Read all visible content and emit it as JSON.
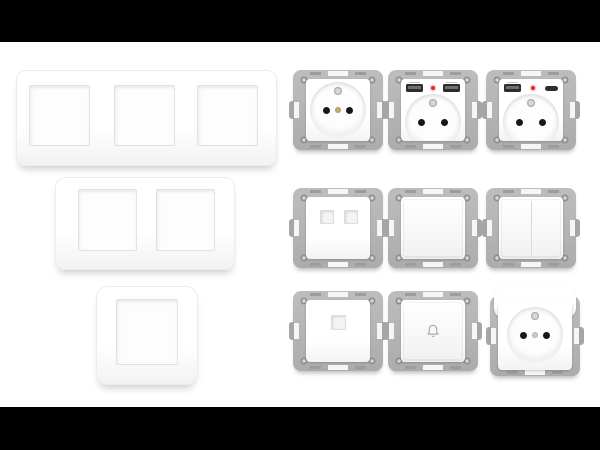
{
  "scene": {
    "kind": "product-photo",
    "subject": "white electrical wall plates and socket/switch mechanisms on metal mounting frames",
    "letterbox_color": "#000000",
    "background_color": "#ffffff"
  },
  "colors": {
    "plate_white": "#ffffff",
    "frame_metal": "#b5b5b5",
    "frame_metal_dark": "#9c9c9c",
    "socket_hole": "#171717",
    "earth_pin_brass": "#9b8352",
    "led_red": "#e02f22",
    "usb_port_dark": "#2d2d2d"
  },
  "wall_plates": [
    {
      "name": "triple-gang-frame",
      "gangs": 3
    },
    {
      "name": "double-gang-frame",
      "gangs": 2
    },
    {
      "name": "single-gang-frame",
      "gangs": 1
    }
  ],
  "modules": [
    {
      "row": 1,
      "col": 1,
      "type": "french-socket",
      "features": [
        "earth-pin",
        "two-holes",
        "screw"
      ]
    },
    {
      "row": 1,
      "col": 2,
      "type": "french-socket-dual-usb-a",
      "features": [
        "usb-a",
        "red-led",
        "usb-a",
        "two-holes"
      ]
    },
    {
      "row": 1,
      "col": 3,
      "type": "french-socket-usb-a-c",
      "features": [
        "usb-a",
        "red-led",
        "usb-c",
        "two-holes"
      ]
    },
    {
      "row": 2,
      "col": 1,
      "type": "double-data-outlet",
      "features": [
        "two-square-ports"
      ]
    },
    {
      "row": 2,
      "col": 2,
      "type": "single-switch",
      "features": [
        "blank-rocker"
      ]
    },
    {
      "row": 2,
      "col": 3,
      "type": "double-switch",
      "features": [
        "split-rocker"
      ]
    },
    {
      "row": 3,
      "col": 1,
      "type": "rj45-data-outlet",
      "features": [
        "one-square-port"
      ]
    },
    {
      "row": 3,
      "col": 2,
      "type": "doorbell-push-button",
      "icon": "bell-icon"
    },
    {
      "row": 3,
      "col": 3,
      "type": "french-socket-with-cover",
      "features": [
        "hinged-cover",
        "earth-pin",
        "two-holes"
      ]
    }
  ]
}
